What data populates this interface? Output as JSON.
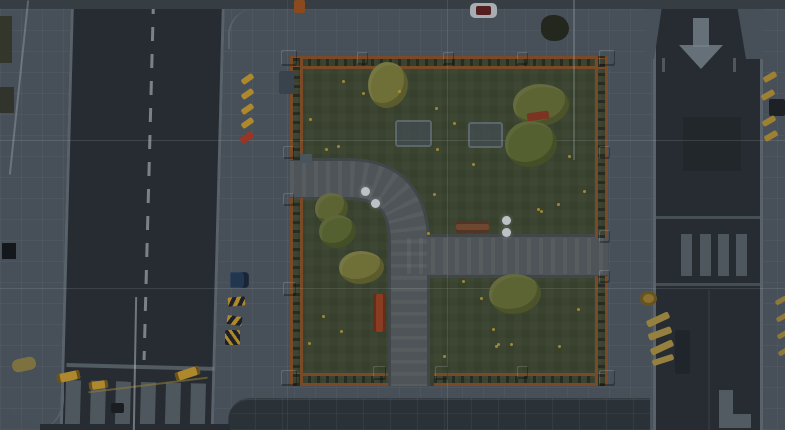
{
  "scene": {
    "colors": {
      "sidewalk": "#475059",
      "road": "#262c32",
      "curb": "#59626a",
      "marking": "#76828a",
      "grass": "#3a432f",
      "path": "#4e5457",
      "path_edge": "#414649",
      "fence_rail": "#7a4a26",
      "fence_post": "#935826",
      "tree": "#5d6434",
      "tree2": "#546030",
      "tree_light": "#6f7038",
      "flower": "#b29433",
      "barrier_yellow": "#ad882c",
      "cone_red": "#9a3424",
      "car_blue": "#223650",
      "grid_line": "#cdd5d9",
      "band_top": "#363d43",
      "band_bottom": "#2a3137",
      "lamp": "#bcc3c7"
    },
    "park": {
      "walkway_main_d": "M 0 123 L 58 123 Q 119 123 119 187 L 119 332",
      "walkway_cross_d": "M 117 200 L 318 200"
    },
    "left_road": {
      "items": [
        {
          "n": "stop-line",
          "x": 2,
          "y": 365,
          "w": 148,
          "h": 4,
          "c": "marking",
          "o": 0.55
        },
        {
          "n": "crosswalk-stripe",
          "x": 2,
          "y": 382,
          "w": 15,
          "h": 46,
          "c": "marking",
          "o": 0.5
        },
        {
          "n": "crosswalk-stripe",
          "x": 27,
          "y": 382,
          "w": 15,
          "h": 46,
          "c": "marking",
          "o": 0.5
        },
        {
          "n": "crosswalk-stripe",
          "x": 52,
          "y": 382,
          "w": 15,
          "h": 46,
          "c": "marking",
          "o": 0.5
        },
        {
          "n": "crosswalk-stripe",
          "x": 77,
          "y": 382,
          "w": 15,
          "h": 46,
          "c": "marking",
          "o": 0.5
        },
        {
          "n": "crosswalk-stripe",
          "x": 102,
          "y": 382,
          "w": 15,
          "h": 46,
          "c": "marking",
          "o": 0.5
        },
        {
          "n": "crosswalk-stripe",
          "x": 127,
          "y": 382,
          "w": 15,
          "h": 46,
          "c": "marking",
          "o": 0.5
        }
      ]
    },
    "right_road": {
      "items": [
        {
          "n": "road-arrow-shaft",
          "x": 37,
          "y": 13,
          "w": 16,
          "h": 29,
          "c": "marking",
          "o": 0.8
        },
        {
          "n": "road-arrow-head",
          "x": 23,
          "y": 40,
          "cls": "arrow-head"
        },
        {
          "n": "road-dark-patch",
          "x": 27,
          "y": 112,
          "w": 58,
          "h": 54,
          "c": "rgba(0,0,0,0.10)"
        },
        {
          "n": "crosswalk-line",
          "x": 0,
          "y": 211,
          "w": 104,
          "h": 3,
          "c": "marking",
          "o": 0.4
        },
        {
          "n": "crosswalk-stripe",
          "x": 25,
          "y": 229,
          "w": 11,
          "h": 42,
          "c": "marking",
          "o": 0.5
        },
        {
          "n": "crosswalk-stripe",
          "x": 44,
          "y": 229,
          "w": 11,
          "h": 42,
          "c": "marking",
          "o": 0.5
        },
        {
          "n": "crosswalk-stripe",
          "x": 62,
          "y": 229,
          "w": 11,
          "h": 42,
          "c": "marking",
          "o": 0.5
        },
        {
          "n": "crosswalk-stripe",
          "x": 80,
          "y": 229,
          "w": 11,
          "h": 42,
          "c": "marking",
          "o": 0.5
        },
        {
          "n": "crosswalk-line",
          "x": 0,
          "y": 278,
          "w": 104,
          "h": 3,
          "c": "marking",
          "o": 0.4
        },
        {
          "n": "parked-car-dark",
          "x": 19,
          "y": 325,
          "w": 15,
          "h": 44,
          "c": "#1f252a",
          "r": 3
        },
        {
          "n": "lane-seam",
          "x": 52,
          "y": 285,
          "w": 2,
          "h": 140,
          "c": "rgba(255,255,255,0.05)"
        },
        {
          "n": "road-marking-L",
          "x": 63,
          "y": 385,
          "w": 14,
          "h": 38,
          "c": "marking",
          "o": 0.55
        },
        {
          "n": "road-marking-L",
          "x": 77,
          "y": 409,
          "w": 18,
          "h": 14,
          "c": "marking",
          "o": 0.55
        }
      ]
    },
    "trees": [
      {
        "n": "tree",
        "x": 368,
        "y": 62,
        "w": 40,
        "h": 46,
        "c": "tree_light",
        "cls": "tree"
      },
      {
        "n": "tree",
        "x": 513,
        "y": 84,
        "w": 56,
        "h": 42,
        "c": "tree",
        "cls": "tree"
      },
      {
        "n": "tree",
        "x": 505,
        "y": 121,
        "w": 52,
        "h": 46,
        "c": "tree2",
        "cls": "tree"
      },
      {
        "n": "tree",
        "x": 315,
        "y": 193,
        "w": 33,
        "h": 31,
        "c": "tree",
        "cls": "tree"
      },
      {
        "n": "tree",
        "x": 319,
        "y": 215,
        "w": 37,
        "h": 33,
        "c": "tree2",
        "cls": "tree"
      },
      {
        "n": "tree",
        "x": 339,
        "y": 251,
        "w": 45,
        "h": 33,
        "c": "tree_light",
        "cls": "tree"
      },
      {
        "n": "tree",
        "x": 489,
        "y": 274,
        "w": 52,
        "h": 40,
        "c": "tree",
        "cls": "tree"
      }
    ],
    "flowers": [
      {
        "x": 342,
        "y": 80
      },
      {
        "x": 362,
        "y": 92
      },
      {
        "x": 435,
        "y": 107
      },
      {
        "x": 453,
        "y": 122
      },
      {
        "x": 337,
        "y": 145
      },
      {
        "x": 325,
        "y": 148
      },
      {
        "x": 436,
        "y": 148
      },
      {
        "x": 472,
        "y": 163
      },
      {
        "x": 433,
        "y": 193
      },
      {
        "x": 568,
        "y": 155
      },
      {
        "x": 583,
        "y": 190
      },
      {
        "x": 540,
        "y": 210
      },
      {
        "x": 557,
        "y": 203
      },
      {
        "x": 537,
        "y": 208
      },
      {
        "x": 427,
        "y": 232
      },
      {
        "x": 462,
        "y": 280
      },
      {
        "x": 480,
        "y": 297
      },
      {
        "x": 492,
        "y": 328
      },
      {
        "x": 510,
        "y": 343
      },
      {
        "x": 577,
        "y": 308
      },
      {
        "x": 558,
        "y": 345
      },
      {
        "x": 495,
        "y": 345
      },
      {
        "x": 322,
        "y": 315
      },
      {
        "x": 340,
        "y": 330
      },
      {
        "x": 308,
        "y": 342
      },
      {
        "x": 443,
        "y": 355
      },
      {
        "x": 497,
        "y": 343
      },
      {
        "x": 309,
        "y": 118
      },
      {
        "x": 398,
        "y": 90
      }
    ],
    "lamps": [
      {
        "n": "lamp-globe",
        "x": 361,
        "y": 187,
        "w": 9,
        "h": 9,
        "cls": "lamp"
      },
      {
        "n": "lamp-globe",
        "x": 371,
        "y": 199,
        "w": 9,
        "h": 9,
        "cls": "lamp"
      },
      {
        "n": "lamp-globe",
        "x": 502,
        "y": 216,
        "w": 9,
        "h": 9,
        "cls": "lamp"
      },
      {
        "n": "lamp-globe",
        "x": 502,
        "y": 228,
        "w": 9,
        "h": 9,
        "cls": "lamp"
      }
    ],
    "fence_posts": [
      {
        "x": 281,
        "y": 50,
        "w": 16,
        "h": 16
      },
      {
        "x": 599,
        "y": 50,
        "w": 16,
        "h": 16
      },
      {
        "x": 281,
        "y": 370,
        "w": 16,
        "h": 16
      },
      {
        "x": 599,
        "y": 370,
        "w": 16,
        "h": 16
      },
      {
        "x": 357,
        "y": 52,
        "w": 11,
        "h": 13
      },
      {
        "x": 443,
        "y": 52,
        "w": 11,
        "h": 13
      },
      {
        "x": 517,
        "y": 52,
        "w": 11,
        "h": 13
      },
      {
        "x": 283,
        "y": 146,
        "w": 11,
        "h": 13
      },
      {
        "x": 283,
        "y": 193,
        "w": 11,
        "h": 13
      },
      {
        "x": 283,
        "y": 282,
        "w": 13,
        "h": 14
      },
      {
        "x": 599,
        "y": 230,
        "w": 11,
        "h": 13
      },
      {
        "x": 599,
        "y": 270,
        "w": 11,
        "h": 13
      },
      {
        "x": 599,
        "y": 146,
        "w": 11,
        "h": 13
      },
      {
        "x": 373,
        "y": 366,
        "w": 13,
        "h": 14
      },
      {
        "x": 435,
        "y": 366,
        "w": 13,
        "h": 14
      },
      {
        "x": 517,
        "y": 366,
        "w": 11,
        "h": 13
      }
    ],
    "grid_lines": [
      {
        "n": "grid-line-h",
        "x": 0,
        "y": 140,
        "w": 785,
        "h": 1,
        "c": "grid_line",
        "o": 0.14
      },
      {
        "n": "grid-line-h",
        "x": 0,
        "y": 288,
        "w": 785,
        "h": 1,
        "c": "grid_line",
        "o": 0.13
      },
      {
        "n": "grid-line-v",
        "x": 287,
        "y": 0,
        "w": 1,
        "h": 430,
        "c": "grid_line",
        "o": 0.08
      },
      {
        "n": "grid-line-v",
        "x": 447,
        "y": 0,
        "w": 1,
        "h": 430,
        "c": "grid_line",
        "o": 0.13
      }
    ],
    "objects": [
      {
        "n": "roof-edge",
        "x": 0,
        "y": 16,
        "w": 12,
        "h": 47,
        "c": "#33362b"
      },
      {
        "n": "roof-edge",
        "x": 0,
        "y": 87,
        "w": 14,
        "h": 26,
        "c": "#31342a"
      },
      {
        "n": "black-box",
        "x": 2,
        "y": 243,
        "w": 14,
        "h": 16,
        "c": "#14181d"
      },
      {
        "n": "fallen-log",
        "x": 12,
        "y": 358,
        "w": 24,
        "h": 13,
        "c": "#7e7140",
        "r": 6,
        "rot": -12
      },
      {
        "n": "white-van",
        "x": 470,
        "y": 3,
        "w": 27,
        "h": 15,
        "c": "#a7adb2",
        "r": 5
      },
      {
        "n": "van-roof",
        "x": 476,
        "y": 6,
        "w": 15,
        "h": 9,
        "c": "#54201f",
        "r": 2
      },
      {
        "n": "dark-bush",
        "x": 541,
        "y": 15,
        "w": 28,
        "h": 26,
        "c": "#23271e",
        "r": "42% 55% 50% 45%"
      },
      {
        "n": "traffic-cone",
        "x": 294,
        "y": 0,
        "w": 11,
        "h": 13,
        "c": "#8a4a1e",
        "r": 2
      },
      {
        "n": "dumpster",
        "x": 279,
        "y": 71,
        "w": 15,
        "h": 23,
        "c": "#39434e",
        "r": 2
      },
      {
        "n": "sign-plate",
        "x": 300,
        "y": 154,
        "w": 12,
        "h": 9,
        "c": "#4a545b"
      },
      {
        "n": "marker-dash",
        "x": 241,
        "y": 76,
        "w": 13,
        "h": 6,
        "c": "barrier_yellow",
        "rot": -35,
        "r": 2
      },
      {
        "n": "marker-dash",
        "x": 241,
        "y": 91,
        "w": 13,
        "h": 6,
        "c": "barrier_yellow",
        "rot": -35,
        "r": 2
      },
      {
        "n": "marker-dash",
        "x": 241,
        "y": 106,
        "w": 13,
        "h": 6,
        "c": "barrier_yellow",
        "rot": -35,
        "r": 2
      },
      {
        "n": "marker-dash",
        "x": 241,
        "y": 120,
        "w": 13,
        "h": 6,
        "c": "barrier_yellow",
        "rot": -35,
        "r": 2
      },
      {
        "n": "marker-dash-red",
        "x": 240,
        "y": 134,
        "w": 14,
        "h": 7,
        "c": "cone_red",
        "rot": -35,
        "r": 2
      },
      {
        "n": "parked-car-blue",
        "x": 230,
        "y": 272,
        "w": 19,
        "h": 16,
        "c": "car_blue",
        "cls": "car"
      },
      {
        "n": "hazard-barrier",
        "x": 228,
        "y": 297,
        "w": 17,
        "h": 9,
        "cls": "hazard",
        "rot": -5
      },
      {
        "n": "hazard-barrier",
        "x": 227,
        "y": 316,
        "w": 15,
        "h": 9,
        "cls": "hazard",
        "rot": 8
      },
      {
        "n": "hazard-barrier",
        "x": 225,
        "y": 330,
        "w": 15,
        "h": 15,
        "cls": "hazard2"
      },
      {
        "n": "bench-wood",
        "x": 456,
        "y": 221,
        "w": 33,
        "h": 12,
        "c": "#6e4730",
        "cls": "bench"
      },
      {
        "n": "bench-vertical",
        "x": 373,
        "y": 294,
        "w": 13,
        "h": 38,
        "c": "#8a3c22",
        "cls": "bench-v"
      },
      {
        "n": "bench-red",
        "x": 527,
        "y": 112,
        "w": 22,
        "h": 8,
        "c": "#7b3322",
        "rot": -8,
        "r": 2
      },
      {
        "n": "curb-mark",
        "x": 662,
        "y": 58,
        "w": 3,
        "h": 14,
        "c": "marking",
        "o": 0.5
      },
      {
        "n": "curb-mark",
        "x": 733,
        "y": 58,
        "w": 3,
        "h": 14,
        "c": "marking",
        "o": 0.5
      },
      {
        "n": "edge-dash",
        "x": 763,
        "y": 74,
        "w": 14,
        "h": 6,
        "c": "barrier_yellow",
        "rot": -30,
        "o": 0.85,
        "r": 2
      },
      {
        "n": "edge-dash",
        "x": 761,
        "y": 92,
        "w": 14,
        "h": 6,
        "c": "barrier_yellow",
        "rot": -30,
        "o": 0.85,
        "r": 2
      },
      {
        "n": "parked-car-edge",
        "x": 769,
        "y": 99,
        "w": 16,
        "h": 17,
        "c": "#1d2126",
        "r": 2
      },
      {
        "n": "edge-dash",
        "x": 762,
        "y": 118,
        "w": 14,
        "h": 6,
        "c": "barrier_yellow",
        "rot": -30,
        "o": 0.85,
        "r": 2
      },
      {
        "n": "edge-dash",
        "x": 764,
        "y": 133,
        "w": 14,
        "h": 6,
        "c": "barrier_yellow",
        "rot": -30,
        "o": 0.85,
        "r": 2
      },
      {
        "n": "edge-dash",
        "x": 775,
        "y": 298,
        "w": 12,
        "h": 5,
        "c": "barrier_yellow",
        "rot": -30,
        "o": 0.7,
        "r": 2
      },
      {
        "n": "edge-dash",
        "x": 776,
        "y": 315,
        "w": 12,
        "h": 5,
        "c": "barrier_yellow",
        "rot": -30,
        "o": 0.7,
        "r": 2
      },
      {
        "n": "edge-dash",
        "x": 777,
        "y": 332,
        "w": 12,
        "h": 5,
        "c": "barrier_yellow",
        "rot": -30,
        "o": 0.7,
        "r": 2
      },
      {
        "n": "edge-dash",
        "x": 778,
        "y": 349,
        "w": 12,
        "h": 5,
        "c": "barrier_yellow",
        "rot": -30,
        "o": 0.7,
        "r": 2
      },
      {
        "n": "gold-barrel",
        "x": 640,
        "y": 291,
        "w": 17,
        "h": 15,
        "c": "#8a6f2e",
        "r": "50%",
        "cls": "barrel"
      },
      {
        "n": "plank",
        "x": 646,
        "y": 316,
        "w": 24,
        "h": 7,
        "c": "#96803f",
        "rot": -25,
        "r": 2
      },
      {
        "n": "plank",
        "x": 648,
        "y": 330,
        "w": 24,
        "h": 7,
        "c": "#96803f",
        "rot": -20,
        "r": 2
      },
      {
        "n": "plank",
        "x": 650,
        "y": 344,
        "w": 24,
        "h": 7,
        "c": "#96803f",
        "rot": -25,
        "r": 2
      },
      {
        "n": "plank",
        "x": 652,
        "y": 357,
        "w": 22,
        "h": 6,
        "c": "#96803f",
        "rot": -18,
        "r": 2
      },
      {
        "n": "gold-barrier",
        "x": 57,
        "y": 372,
        "w": 23,
        "h": 9,
        "cls": "gold",
        "rot": -12
      },
      {
        "n": "gold-barrier",
        "x": 89,
        "y": 381,
        "w": 19,
        "h": 8,
        "cls": "gold",
        "rot": -8
      },
      {
        "n": "gold-barrier",
        "x": 175,
        "y": 369,
        "w": 25,
        "h": 9,
        "cls": "gold",
        "rot": -18
      },
      {
        "n": "rope-line",
        "x": 88,
        "y": 384,
        "w": 120,
        "h": 2,
        "c": "#8a7838",
        "rot": -7,
        "o": 0.6
      },
      {
        "n": "debris",
        "x": 111,
        "y": 403,
        "w": 13,
        "h": 10,
        "c": "#1a1e23",
        "r": 2
      },
      {
        "n": "lamp-pole",
        "x": 134,
        "y": 297,
        "w": 2,
        "h": 133,
        "c": "#b9c1c5",
        "o": 0.5,
        "rot": 1
      },
      {
        "n": "pole-line",
        "x": 18,
        "y": 0,
        "w": 2,
        "h": 175,
        "c": "#c9d1d5",
        "o": 0.28,
        "rot": 6
      },
      {
        "n": "pole-line",
        "x": 573,
        "y": 0,
        "w": 2,
        "h": 160,
        "c": "#c9d1d5",
        "o": 0.22
      }
    ]
  }
}
